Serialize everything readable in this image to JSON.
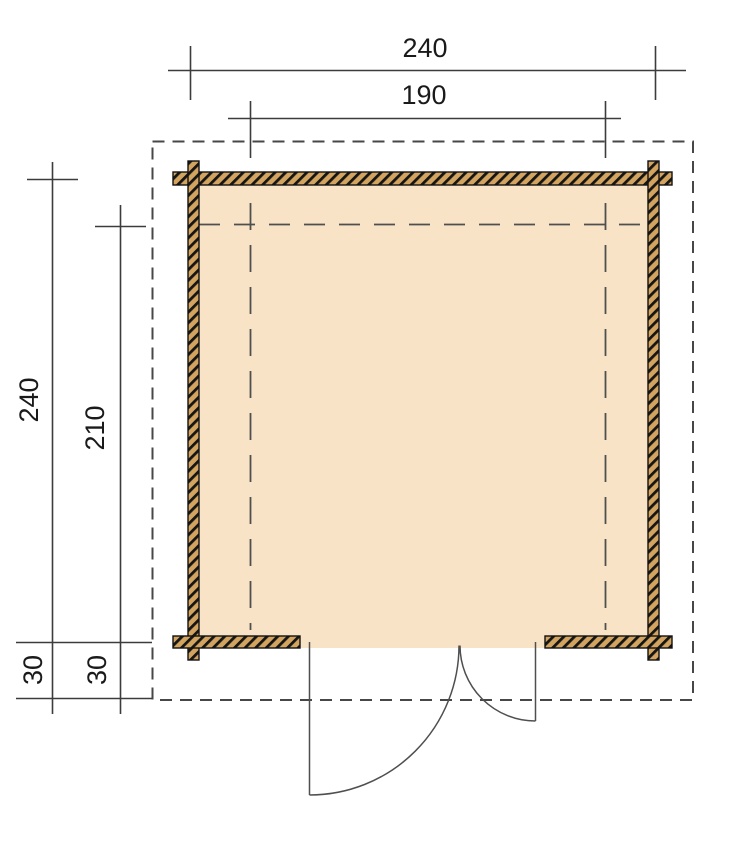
{
  "drawing": {
    "kind": "garden-house-floor-plan",
    "dimensions": {
      "top_outer_width": "240",
      "top_inner_width": "190",
      "left_outer_depth": "240",
      "left_inner_depth": "210",
      "overhang_outer": "30",
      "overhang_inner": "30"
    },
    "colors": {
      "background": "#ffffff",
      "floor_fill": "#f8e3c6",
      "wall_fill": "#d2a45f",
      "wall_hatch": "#151515",
      "wall_border": "#111111",
      "dimension_line": "#3c3c3c",
      "dashed_outline": "#474747",
      "interior_dashed": "#4f4f4f",
      "door_line": "#4f4f4f",
      "text": "#1a1a1a"
    }
  }
}
